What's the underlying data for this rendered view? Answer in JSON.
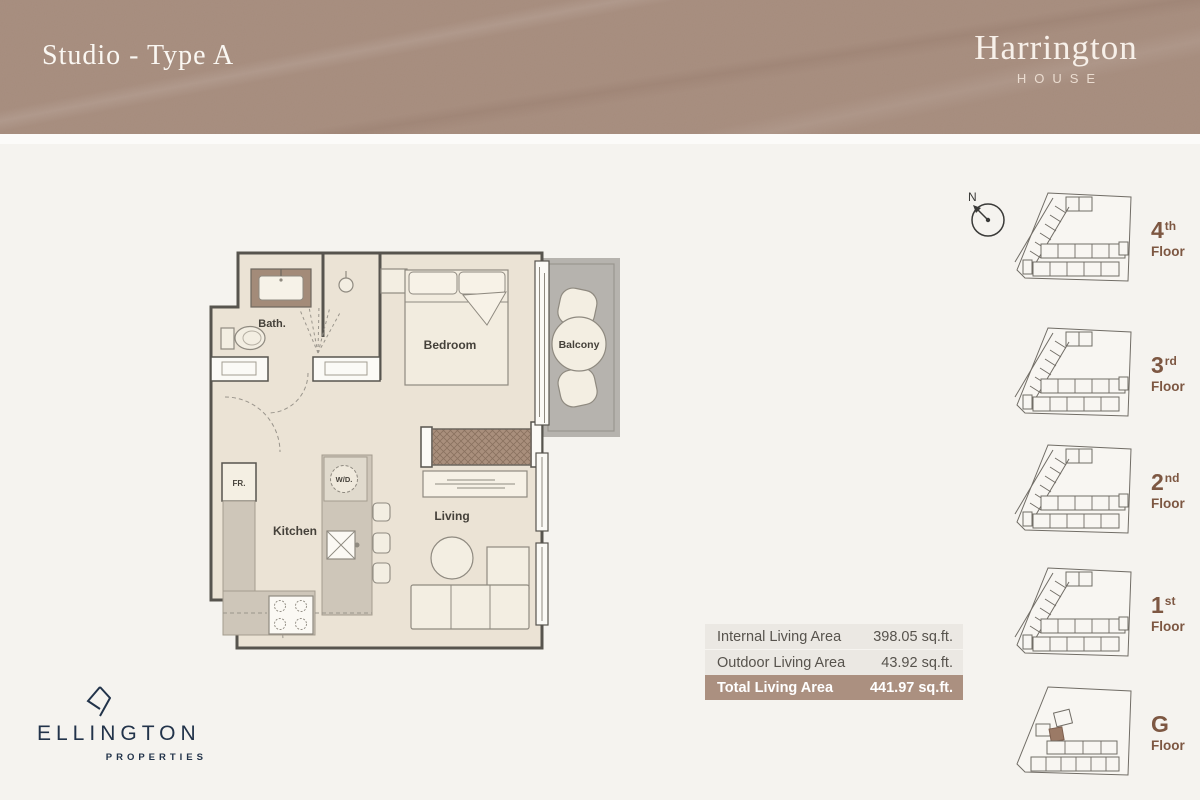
{
  "banner": {
    "title": "Studio - Type A",
    "brand_name": "Harrington",
    "brand_sub": "HOUSE"
  },
  "plan": {
    "rooms": {
      "bath": "Bath.",
      "bedroom": "Bedroom",
      "balcony": "Balcony",
      "fridge": "FR.",
      "washer": "W/D.",
      "kitchen": "Kitchen",
      "living": "Living"
    }
  },
  "areas": {
    "rows": [
      {
        "label": "Internal Living Area",
        "value": "398.05 sq.ft."
      },
      {
        "label": "Outdoor Living Area",
        "value": "43.92 sq.ft."
      },
      {
        "label": "Total Living Area",
        "value": "441.97 sq.ft."
      }
    ]
  },
  "compass": {
    "label": "N"
  },
  "floors": [
    {
      "num": "4",
      "ordinal": "th",
      "label": "Floor"
    },
    {
      "num": "3",
      "ordinal": "rd",
      "label": "Floor"
    },
    {
      "num": "2",
      "ordinal": "nd",
      "label": "Floor"
    },
    {
      "num": "1",
      "ordinal": "st",
      "label": "Floor"
    },
    {
      "num": "G",
      "ordinal": "",
      "label": "Floor",
      "unit_highlighted": true
    }
  ],
  "logo": {
    "name": "ELLINGTON",
    "sub": "PROPERTIES"
  },
  "colors": {
    "banner_bg": "#a68c7d",
    "page_bg": "#f5f3ef",
    "navy": "#22334a",
    "floor_label_brown": "#7d5742",
    "table_light_bg": "#ebe8e3",
    "table_total_bg": "#ab9080",
    "plan_wall": "#57544e",
    "plan_interior": "#ebe3d5",
    "plan_counter": "#cec6b9",
    "balcony_gray": "#b6b3ae",
    "wardrobe_brown": "#a98f7c",
    "highlight_unit_brown": "#9b7a66"
  }
}
